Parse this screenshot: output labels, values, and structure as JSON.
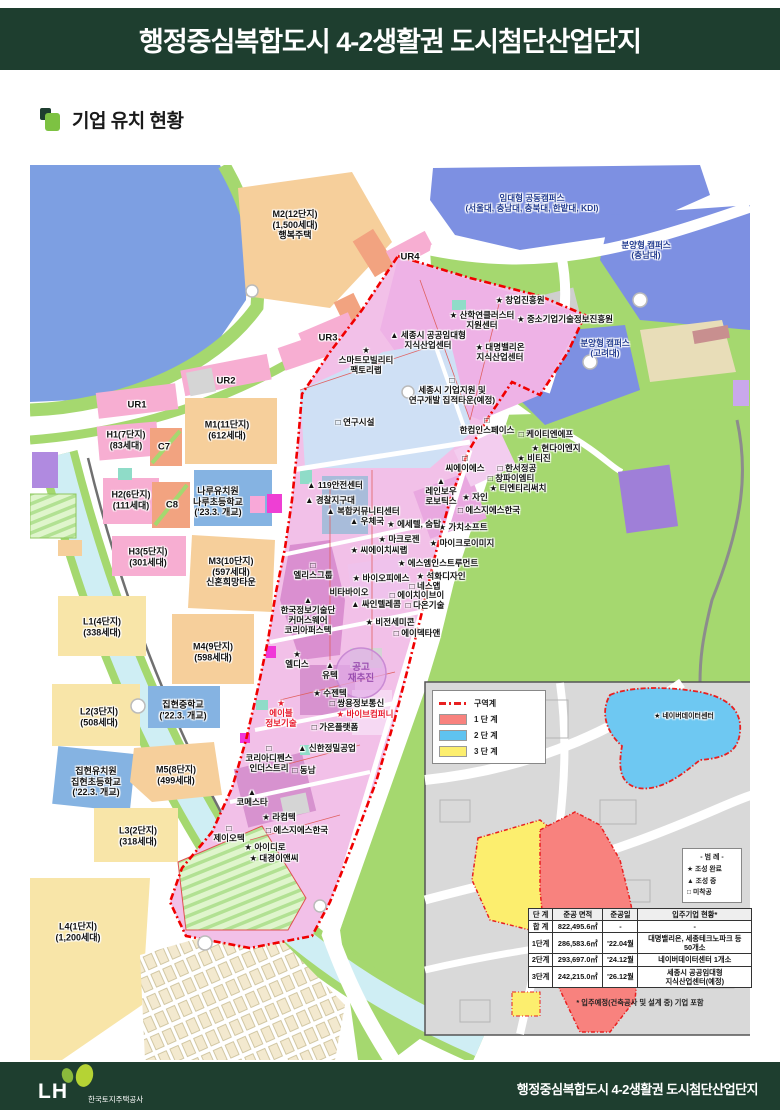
{
  "header": {
    "title": "행정중심복합도시 4-2생활권 도시첨단산업단지"
  },
  "section": {
    "title": "기업 유치 현황"
  },
  "colors": {
    "header_green": "#1e3e2f",
    "accent_green": "#7dc242",
    "boundary_red": "#f00000",
    "phase1_red": "#f8827e",
    "phase2_blue": "#5fc3f0",
    "phase3_yellow": "#fcee6e",
    "water_blue": "#7d9fe2",
    "hill_green": "#a5d86f",
    "industry_pink": "#f2c0e8"
  },
  "map": {
    "notice": {
      "text": "공고\n재추진"
    },
    "labels": [
      {
        "t": "M2(12단지)\n(1,500세대)\n행복주택",
        "x": 295,
        "y": 225,
        "cls": "area"
      },
      {
        "t": "M1(11단지)\n(612세대)",
        "x": 227,
        "y": 430,
        "cls": "area"
      },
      {
        "t": "H1(7단지)\n(83세대)",
        "x": 126,
        "y": 440,
        "cls": "area"
      },
      {
        "t": "C7",
        "x": 164,
        "y": 447,
        "cls": "tag"
      },
      {
        "t": "H2(6단지)\n(111세대)",
        "x": 131,
        "y": 500,
        "cls": "area"
      },
      {
        "t": "C8",
        "x": 172,
        "y": 505,
        "cls": "tag"
      },
      {
        "t": "나루유치원\n나루초등학교\n('23.3. 개교)",
        "x": 218,
        "y": 502,
        "cls": "area"
      },
      {
        "t": "H3(5단지)\n(301세대)",
        "x": 148,
        "y": 557,
        "cls": "area"
      },
      {
        "t": "M3(10단지)\n(597세대)\n신혼희망타운",
        "x": 231,
        "y": 572,
        "cls": "area"
      },
      {
        "t": "L1(4단지)\n(338세대)",
        "x": 102,
        "y": 627,
        "cls": "area"
      },
      {
        "t": "M4(9단지)\n(598세대)",
        "x": 213,
        "y": 652,
        "cls": "area"
      },
      {
        "t": "집현중학교\n('22.3. 개교)",
        "x": 183,
        "y": 710,
        "cls": "area"
      },
      {
        "t": "L2(3단지)\n(508세대)",
        "x": 99,
        "y": 717,
        "cls": "area"
      },
      {
        "t": "집현유치원\n집현초등학교\n('22.3. 개교)",
        "x": 96,
        "y": 782,
        "cls": "area"
      },
      {
        "t": "M5(8단지)\n(499세대)",
        "x": 176,
        "y": 775,
        "cls": "area"
      },
      {
        "t": "L3(2단지)\n(318세대)",
        "x": 138,
        "y": 836,
        "cls": "area"
      },
      {
        "t": "L4(1단지)\n(1,200세대)",
        "x": 78,
        "y": 932,
        "cls": "area"
      },
      {
        "t": "UR1",
        "x": 137,
        "y": 405,
        "cls": "tag"
      },
      {
        "t": "UR2",
        "x": 226,
        "y": 381,
        "cls": "tag"
      },
      {
        "t": "UR3",
        "x": 328,
        "y": 338,
        "cls": "tag"
      },
      {
        "t": "UR4",
        "x": 410,
        "y": 257,
        "cls": "tag"
      },
      {
        "t": "임대형 공동캠퍼스\n(서울대, 충남대, 충북대, 한밭대, KDI)",
        "x": 532,
        "y": 203,
        "cls": "campus"
      },
      {
        "t": "분양형 캠퍼스\n(충남대)",
        "x": 646,
        "y": 250,
        "cls": "campus"
      },
      {
        "t": "분양형 캠퍼스\n(고려대)",
        "x": 605,
        "y": 348,
        "cls": "campus"
      },
      {
        "t": "연구시설",
        "x": 355,
        "y": 422,
        "m": "square"
      },
      {
        "t": "스마트모빌리티\n팩토리랩",
        "x": 366,
        "y": 360,
        "m": "star",
        "nl": true
      },
      {
        "t": "산학연클러스터\n지원센터",
        "x": 482,
        "y": 320,
        "m": "star"
      },
      {
        "t": "창업진흥원",
        "x": 520,
        "y": 300,
        "m": "star"
      },
      {
        "t": "중소기업기술정보진흥원",
        "x": 565,
        "y": 319,
        "m": "star"
      },
      {
        "t": "세종시 공공임대형\n지식산업센터",
        "x": 428,
        "y": 340,
        "m": "triangle"
      },
      {
        "t": "대명밸리온\n지식산업센터",
        "x": 500,
        "y": 352,
        "m": "star"
      },
      {
        "t": "세종시 기업지원 및\n연구개발 집적타운(예정)",
        "x": 452,
        "y": 390,
        "m": "square",
        "nl": true
      },
      {
        "t": "한컴인스페이스",
        "x": 487,
        "y": 425,
        "m": "square",
        "nl": true
      },
      {
        "t": "케이티엔에프",
        "x": 546,
        "y": 434,
        "m": "square"
      },
      {
        "t": "현다이엔지",
        "x": 556,
        "y": 448,
        "m": "star"
      },
      {
        "t": "비티진",
        "x": 534,
        "y": 458,
        "m": "star"
      },
      {
        "t": "씨에이에스",
        "x": 465,
        "y": 463,
        "m": "square",
        "nl": true
      },
      {
        "t": "한서정공",
        "x": 517,
        "y": 468,
        "m": "square"
      },
      {
        "t": "창파이엠티",
        "x": 511,
        "y": 478,
        "m": "square"
      },
      {
        "t": "티엔티리써치",
        "x": 518,
        "y": 488,
        "m": "star"
      },
      {
        "t": "레인보우\n로보틱스",
        "x": 441,
        "y": 491,
        "m": "triangle",
        "nl": true
      },
      {
        "t": "자인",
        "x": 475,
        "y": 497,
        "m": "star"
      },
      {
        "t": "에스지에스한국",
        "x": 489,
        "y": 510,
        "m": "square"
      },
      {
        "t": "가치소프트",
        "x": 463,
        "y": 527,
        "m": "star"
      },
      {
        "t": "마이크로이미지",
        "x": 462,
        "y": 543,
        "m": "star"
      },
      {
        "t": "119안전센터",
        "x": 335,
        "y": 485,
        "m": "triangle"
      },
      {
        "t": "경찰지구대",
        "x": 330,
        "y": 500,
        "m": "triangle"
      },
      {
        "t": "복합커뮤니티센터",
        "x": 363,
        "y": 511,
        "m": "triangle"
      },
      {
        "t": "우체국",
        "x": 367,
        "y": 521,
        "m": "triangle"
      },
      {
        "t": "에세텔, 숨탑",
        "x": 414,
        "y": 524,
        "m": "star"
      },
      {
        "t": "마크로젠",
        "x": 399,
        "y": 539,
        "m": "star"
      },
      {
        "t": "씨에이치씨랩",
        "x": 379,
        "y": 550,
        "m": "star"
      },
      {
        "t": "엘리스그룹",
        "x": 313,
        "y": 570,
        "m": "square",
        "nl": true
      },
      {
        "t": "에스엠인스트루먼트",
        "x": 438,
        "y": 563,
        "m": "star"
      },
      {
        "t": "석화디자인",
        "x": 441,
        "y": 576,
        "m": "star"
      },
      {
        "t": "바이오피에스",
        "x": 381,
        "y": 578,
        "m": "star"
      },
      {
        "t": "네스앱",
        "x": 425,
        "y": 586,
        "m": "square"
      },
      {
        "t": "비타바이오",
        "x": 349,
        "y": 592,
        "m": "none"
      },
      {
        "t": "에이치이브이",
        "x": 417,
        "y": 595,
        "m": "square"
      },
      {
        "t": "싸인텔레콤",
        "x": 376,
        "y": 604,
        "m": "triangle"
      },
      {
        "t": "다온기술",
        "x": 425,
        "y": 605,
        "m": "square"
      },
      {
        "t": "한국정보기술단\n커머스웨어\n코리아퍼스텍",
        "x": 308,
        "y": 615,
        "m": "triangle",
        "nl": true
      },
      {
        "t": "비전세미콘",
        "x": 390,
        "y": 622,
        "m": "star"
      },
      {
        "t": "에이덱타앤",
        "x": 417,
        "y": 633,
        "m": "square"
      },
      {
        "t": "엘디스",
        "x": 297,
        "y": 659,
        "m": "star",
        "nl": true
      },
      {
        "t": "유텍",
        "x": 330,
        "y": 670,
        "m": "triangle",
        "nl": true
      },
      {
        "t": "수젠텍",
        "x": 330,
        "y": 693,
        "m": "star"
      },
      {
        "t": "쌍용정보통신",
        "x": 357,
        "y": 703,
        "m": "square"
      },
      {
        "t": "바이브컴퍼니",
        "x": 365,
        "y": 714,
        "m": "star",
        "cls": "red"
      },
      {
        "t": "에이블\n정보기술",
        "x": 281,
        "y": 713,
        "m": "star",
        "nl": true,
        "cls": "red"
      },
      {
        "t": "가온플랫폼",
        "x": 335,
        "y": 727,
        "m": "square"
      },
      {
        "t": "신한정밀공업",
        "x": 327,
        "y": 748,
        "m": "triangle"
      },
      {
        "t": "동남",
        "x": 304,
        "y": 770,
        "m": "square"
      },
      {
        "t": "코리아디펜스\n인더스트리",
        "x": 269,
        "y": 758,
        "m": "square",
        "nl": true
      },
      {
        "t": "코메스타",
        "x": 252,
        "y": 797,
        "m": "triangle",
        "nl": true
      },
      {
        "t": "라컴텍",
        "x": 279,
        "y": 817,
        "m": "star"
      },
      {
        "t": "제이오텍",
        "x": 229,
        "y": 833,
        "m": "square",
        "nl": true
      },
      {
        "t": "에스지에스한국",
        "x": 297,
        "y": 830,
        "m": "square"
      },
      {
        "t": "아이디로",
        "x": 265,
        "y": 847,
        "m": "star"
      },
      {
        "t": "대경이앤씨",
        "x": 274,
        "y": 858,
        "m": "star"
      },
      {
        "t": "공고\n재추진",
        "x": 361,
        "y": 673,
        "m": "none",
        "cls": "notice"
      },
      {
        "t": "네이버데이터센터",
        "x": 684,
        "y": 717,
        "m": "star",
        "cls": "inset-co"
      }
    ]
  },
  "inset": {
    "phase_legend": [
      {
        "label": "구역계",
        "swatch": "boundary"
      },
      {
        "label": "1 단 계",
        "swatch": "#f8827e"
      },
      {
        "label": "2 단 계",
        "swatch": "#5fc3f0"
      },
      {
        "label": "3 단 계",
        "swatch": "#fcee6e"
      }
    ],
    "marker_legend": {
      "title": "- 범 례 -",
      "items": [
        {
          "glyph": "★",
          "label": "조성 완료"
        },
        {
          "glyph": "▲",
          "label": "조성 중"
        },
        {
          "glyph": "□",
          "label": "미착공"
        }
      ]
    },
    "table": {
      "headers": [
        "단 계",
        "준공 면적",
        "준공일",
        "입주기업 현황*"
      ],
      "rows": [
        [
          "합 계",
          "822,495.6㎡",
          "-",
          "-"
        ],
        [
          "1단계",
          "286,583.6㎡",
          "'22.04월",
          "대명밸리온, 세종테크노파크 등\n50개소"
        ],
        [
          "2단계",
          "293,697.0㎡",
          "'24.12월",
          "네이버데이터센터 1개소"
        ],
        [
          "3단계",
          "242,215.0㎡",
          "'26.12월",
          "세종시 공공임대형\n지식산업센터(예정)"
        ]
      ],
      "footnote": "* 입주예정(건축공사 및 설계 중) 기업 포함"
    }
  },
  "footer": {
    "logo": "LH",
    "org": "한국토지주택공사",
    "title": "행정중심복합도시 4-2생활권 도시첨단산업단지"
  }
}
